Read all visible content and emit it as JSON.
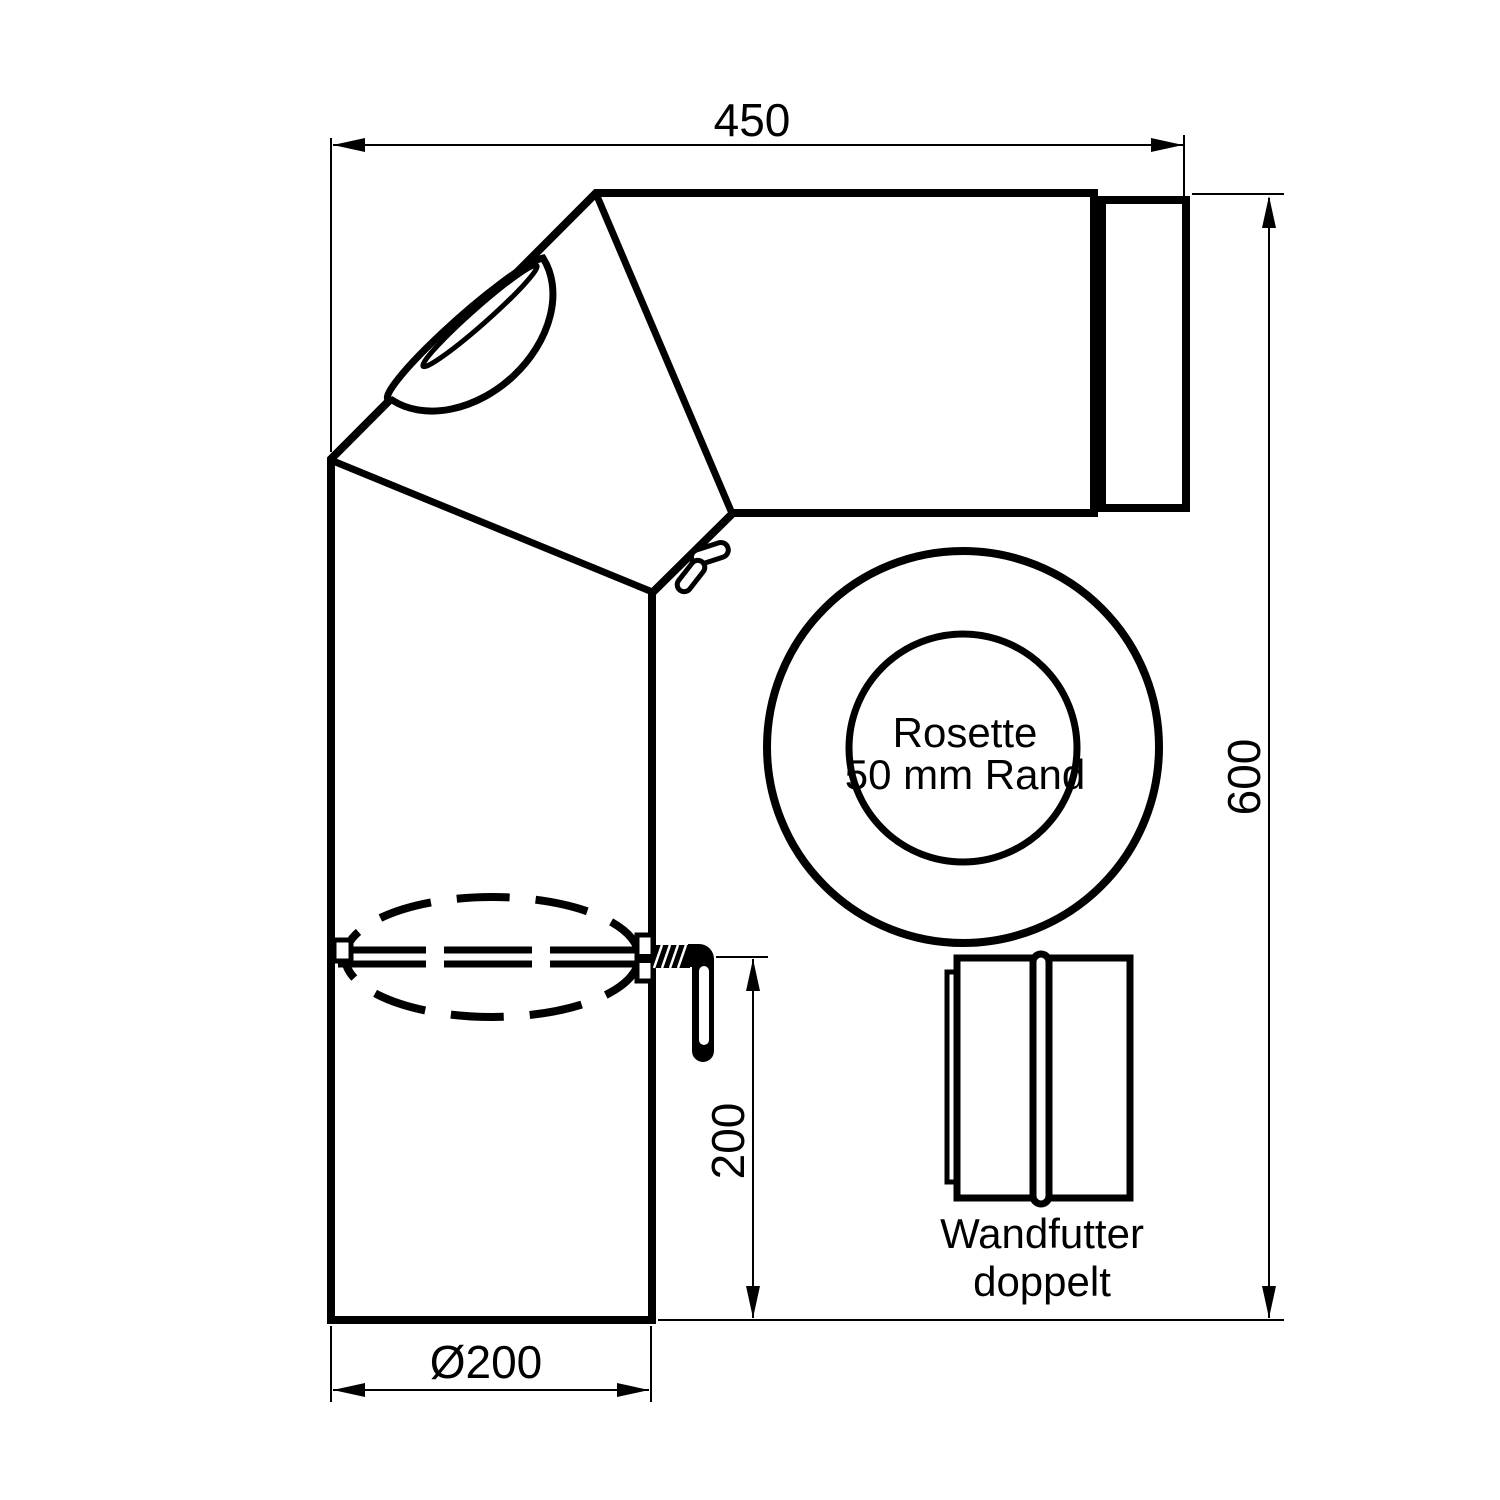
{
  "drawing": {
    "type": "technical-dimension-drawing",
    "product": "stove-pipe-elbow-set",
    "colors": {
      "line": "#000000",
      "background": "#ffffff"
    },
    "dimensions": {
      "top_width": "450",
      "right_height": "600",
      "handle_offset": "200",
      "pipe_diameter": "Ø200"
    },
    "labels": {
      "rosette_line1": "Rosette",
      "rosette_line2": "50 mm Rand",
      "wall_sleeve_line1": "Wandfutter",
      "wall_sleeve_line2": "doppelt"
    }
  }
}
